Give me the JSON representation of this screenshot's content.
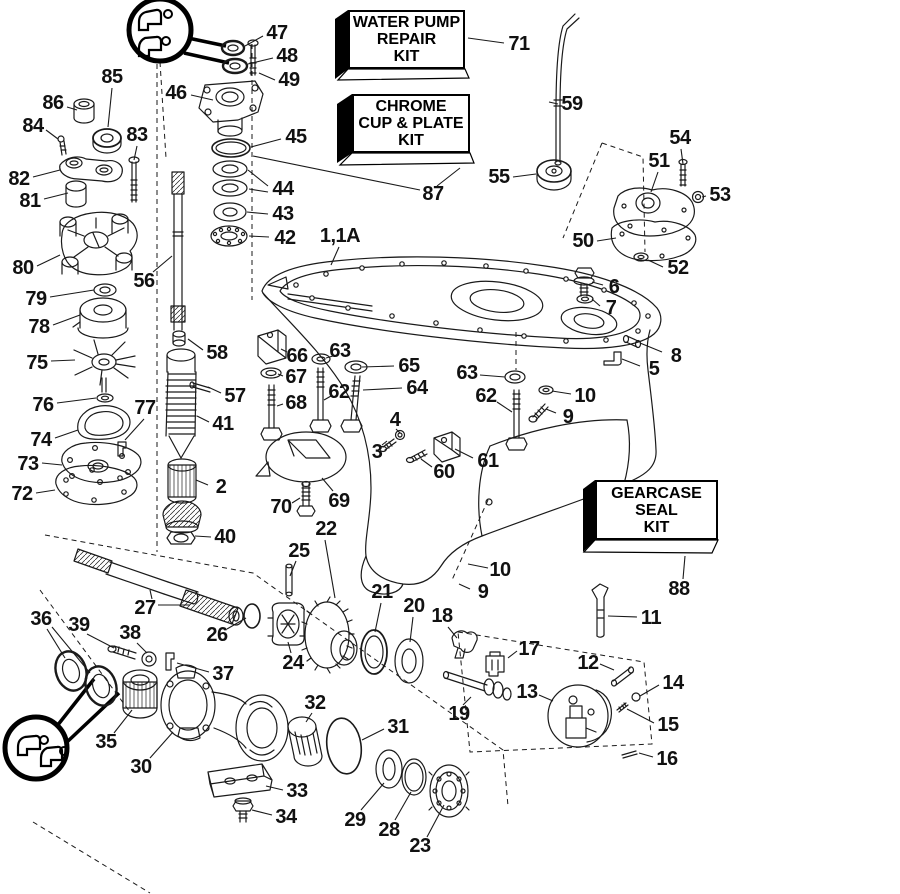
{
  "figure": {
    "background": "#ffffff",
    "ink": "#1a1a1a",
    "description": "Exploded parts diagram - outboard gearcase assembly"
  },
  "kits": {
    "water_pump": {
      "lines": [
        "WATER PUMP",
        "REPAIR",
        "KIT"
      ]
    },
    "chrome": {
      "lines": [
        "CHROME",
        "CUP & PLATE",
        "KIT"
      ]
    },
    "gearcase": {
      "lines": [
        "GEARCASE",
        "SEAL",
        "KIT"
      ]
    }
  },
  "parts": [
    {
      "n": "47",
      "x": 277,
      "y": 33,
      "l": [
        [
          263,
          36,
          245,
          46
        ]
      ]
    },
    {
      "n": "48",
      "x": 287,
      "y": 56,
      "l": [
        [
          273,
          58,
          248,
          64
        ]
      ]
    },
    {
      "n": "49",
      "x": 289,
      "y": 80,
      "l": [
        [
          275,
          80,
          259,
          73
        ]
      ]
    },
    {
      "n": "46",
      "x": 176,
      "y": 93,
      "l": [
        [
          191,
          95,
          213,
          100
        ]
      ]
    },
    {
      "n": "45",
      "x": 296,
      "y": 137,
      "l": [
        [
          281,
          139,
          251,
          147
        ]
      ]
    },
    {
      "n": "44",
      "x": 283,
      "y": 189,
      "l": [
        [
          268,
          186,
          248,
          170
        ],
        [
          268,
          192,
          249,
          189
        ]
      ]
    },
    {
      "n": "43",
      "x": 283,
      "y": 214,
      "l": [
        [
          268,
          214,
          247,
          212
        ]
      ]
    },
    {
      "n": "42",
      "x": 285,
      "y": 238,
      "l": [
        [
          269,
          237,
          249,
          236
        ]
      ]
    },
    {
      "n": "85",
      "x": 112,
      "y": 77,
      "l": [
        [
          112,
          88,
          108,
          127
        ]
      ]
    },
    {
      "n": "86",
      "x": 53,
      "y": 103,
      "l": [
        [
          67,
          107,
          77,
          110
        ]
      ]
    },
    {
      "n": "84",
      "x": 33,
      "y": 126,
      "l": [
        [
          46,
          130,
          58,
          139
        ]
      ]
    },
    {
      "n": "83",
      "x": 137,
      "y": 135,
      "l": [
        [
          137,
          146,
          134,
          160
        ]
      ]
    },
    {
      "n": "82",
      "x": 19,
      "y": 179,
      "l": [
        [
          33,
          177,
          60,
          170
        ]
      ]
    },
    {
      "n": "81",
      "x": 30,
      "y": 201,
      "l": [
        [
          44,
          199,
          68,
          193
        ]
      ]
    },
    {
      "n": "80",
      "x": 23,
      "y": 268,
      "l": [
        [
          37,
          266,
          60,
          255
        ]
      ]
    },
    {
      "n": "79",
      "x": 36,
      "y": 299,
      "l": [
        [
          50,
          297,
          94,
          290
        ]
      ]
    },
    {
      "n": "78",
      "x": 39,
      "y": 327,
      "l": [
        [
          53,
          325,
          80,
          315
        ]
      ]
    },
    {
      "n": "75",
      "x": 37,
      "y": 363,
      "l": [
        [
          51,
          361,
          75,
          360
        ]
      ]
    },
    {
      "n": "76",
      "x": 43,
      "y": 405,
      "l": [
        [
          57,
          403,
          96,
          398
        ]
      ]
    },
    {
      "n": "77",
      "x": 145,
      "y": 408,
      "l": [
        [
          144,
          419,
          125,
          440
        ]
      ]
    },
    {
      "n": "74",
      "x": 41,
      "y": 440,
      "l": [
        [
          55,
          438,
          78,
          430
        ]
      ]
    },
    {
      "n": "73",
      "x": 28,
      "y": 464,
      "l": [
        [
          42,
          463,
          62,
          465
        ]
      ]
    },
    {
      "n": "72",
      "x": 22,
      "y": 494,
      "l": [
        [
          36,
          493,
          55,
          490
        ]
      ]
    },
    {
      "n": "56",
      "x": 144,
      "y": 281,
      "l": [
        [
          153,
          272,
          172,
          256
        ]
      ]
    },
    {
      "n": "58",
      "x": 217,
      "y": 353,
      "l": [
        [
          203,
          350,
          188,
          339
        ]
      ]
    },
    {
      "n": "57",
      "x": 235,
      "y": 396,
      "l": [
        [
          221,
          393,
          208,
          387
        ]
      ]
    },
    {
      "n": "41",
      "x": 223,
      "y": 424,
      "l": [
        [
          209,
          422,
          197,
          416
        ]
      ]
    },
    {
      "n": "2",
      "x": 221,
      "y": 487,
      "l": [
        [
          208,
          485,
          196,
          480
        ]
      ]
    },
    {
      "n": "40",
      "x": 225,
      "y": 537,
      "l": [
        [
          211,
          537,
          195,
          536
        ]
      ]
    },
    {
      "n": "1,1A",
      "x": 340,
      "y": 236,
      "l": [
        [
          339,
          247,
          331,
          265
        ]
      ]
    },
    {
      "n": "87",
      "x": 433,
      "y": 194,
      "l": [
        [
          437,
          186,
          460,
          168
        ],
        [
          420,
          190,
          253,
          156
        ]
      ]
    },
    {
      "n": "71",
      "x": 519,
      "y": 44,
      "l": [
        [
          504,
          43,
          468,
          38
        ]
      ]
    },
    {
      "n": "59",
      "x": 572,
      "y": 104,
      "l": [
        [
          558,
          104,
          549,
          102
        ]
      ]
    },
    {
      "n": "55",
      "x": 499,
      "y": 177,
      "l": [
        [
          513,
          177,
          536,
          174
        ]
      ]
    },
    {
      "n": "54",
      "x": 680,
      "y": 138,
      "l": [
        [
          681,
          149,
          683,
          164
        ]
      ]
    },
    {
      "n": "51",
      "x": 659,
      "y": 161,
      "l": [
        [
          658,
          172,
          651,
          192
        ]
      ]
    },
    {
      "n": "53",
      "x": 720,
      "y": 195,
      "l": [
        [
          706,
          196,
          702,
          197
        ]
      ]
    },
    {
      "n": "50",
      "x": 583,
      "y": 241,
      "l": [
        [
          597,
          241,
          616,
          238
        ]
      ]
    },
    {
      "n": "52",
      "x": 678,
      "y": 268,
      "l": [
        [
          663,
          267,
          648,
          260
        ]
      ]
    },
    {
      "n": "6",
      "x": 614,
      "y": 287,
      "l": [
        [
          603,
          285,
          592,
          282
        ]
      ]
    },
    {
      "n": "7",
      "x": 611,
      "y": 308,
      "l": [
        [
          600,
          306,
          592,
          299
        ]
      ]
    },
    {
      "n": "8",
      "x": 676,
      "y": 356,
      "l": [
        [
          662,
          352,
          640,
          343
        ]
      ]
    },
    {
      "n": "5",
      "x": 654,
      "y": 369,
      "l": [
        [
          640,
          366,
          622,
          359
        ]
      ]
    },
    {
      "n": "66",
      "x": 297,
      "y": 356,
      "l": [
        [
          287,
          352,
          281,
          349
        ]
      ]
    },
    {
      "n": "63",
      "x": 340,
      "y": 351,
      "l": [
        [
          333,
          356,
          326,
          358
        ]
      ]
    },
    {
      "n": "67",
      "x": 296,
      "y": 377,
      "l": [
        [
          283,
          376,
          278,
          374
        ]
      ]
    },
    {
      "n": "65",
      "x": 409,
      "y": 366,
      "l": [
        [
          394,
          366,
          362,
          367
        ]
      ]
    },
    {
      "n": "62",
      "x": 339,
      "y": 392,
      "l": [
        [
          331,
          396,
          324,
          400
        ]
      ]
    },
    {
      "n": "64",
      "x": 417,
      "y": 388,
      "l": [
        [
          402,
          388,
          363,
          390
        ]
      ]
    },
    {
      "n": "68",
      "x": 296,
      "y": 403,
      "l": [
        [
          283,
          404,
          277,
          406
        ]
      ]
    },
    {
      "n": "4",
      "x": 395,
      "y": 420,
      "l": [
        [
          396,
          429,
          400,
          433
        ]
      ]
    },
    {
      "n": "3",
      "x": 377,
      "y": 452,
      "l": [
        [
          382,
          445,
          387,
          441
        ]
      ]
    },
    {
      "n": "60",
      "x": 444,
      "y": 472,
      "l": [
        [
          432,
          467,
          421,
          459
        ]
      ]
    },
    {
      "n": "61",
      "x": 488,
      "y": 461,
      "l": [
        [
          473,
          458,
          455,
          449
        ]
      ]
    },
    {
      "n": "62",
      "x": 486,
      "y": 396,
      "l": [
        [
          497,
          402,
          512,
          412
        ]
      ]
    },
    {
      "n": "63",
      "x": 467,
      "y": 373,
      "l": [
        [
          480,
          375,
          505,
          377
        ]
      ]
    },
    {
      "n": "10",
      "x": 585,
      "y": 396,
      "l": [
        [
          571,
          394,
          552,
          391
        ]
      ]
    },
    {
      "n": "9",
      "x": 568,
      "y": 417,
      "l": [
        [
          556,
          413,
          546,
          409
        ]
      ]
    },
    {
      "n": "69",
      "x": 339,
      "y": 501,
      "l": [
        [
          333,
          491,
          322,
          478
        ]
      ]
    },
    {
      "n": "70",
      "x": 281,
      "y": 507,
      "l": [
        [
          292,
          503,
          300,
          498
        ]
      ]
    },
    {
      "n": "22",
      "x": 326,
      "y": 529,
      "l": [
        [
          325,
          540,
          335,
          598
        ]
      ]
    },
    {
      "n": "25",
      "x": 299,
      "y": 551,
      "l": [
        [
          296,
          561,
          290,
          576
        ]
      ]
    },
    {
      "n": "27",
      "x": 145,
      "y": 608,
      "l": [
        [
          152,
          599,
          150,
          590
        ],
        [
          158,
          605,
          190,
          605
        ]
      ]
    },
    {
      "n": "26",
      "x": 217,
      "y": 635,
      "l": [
        [
          227,
          629,
          246,
          618
        ]
      ]
    },
    {
      "n": "36",
      "x": 41,
      "y": 619,
      "l": [
        [
          47,
          629,
          65,
          658
        ],
        [
          52,
          627,
          90,
          673
        ]
      ]
    },
    {
      "n": "39",
      "x": 79,
      "y": 625,
      "l": [
        [
          87,
          634,
          114,
          648
        ]
      ]
    },
    {
      "n": "38",
      "x": 130,
      "y": 633,
      "l": [
        [
          137,
          643,
          147,
          653
        ]
      ]
    },
    {
      "n": "24",
      "x": 293,
      "y": 663,
      "l": [
        [
          291,
          653,
          288,
          642
        ]
      ]
    },
    {
      "n": "21",
      "x": 382,
      "y": 592,
      "l": [
        [
          381,
          603,
          375,
          632
        ]
      ]
    },
    {
      "n": "20",
      "x": 414,
      "y": 606,
      "l": [
        [
          413,
          617,
          410,
          642
        ]
      ]
    },
    {
      "n": "18",
      "x": 442,
      "y": 616,
      "l": [
        [
          448,
          627,
          457,
          638
        ]
      ]
    },
    {
      "n": "37",
      "x": 223,
      "y": 674,
      "l": [
        [
          209,
          672,
          177,
          663
        ]
      ]
    },
    {
      "n": "35",
      "x": 106,
      "y": 742,
      "l": [
        [
          114,
          733,
          132,
          710
        ]
      ]
    },
    {
      "n": "30",
      "x": 141,
      "y": 767,
      "l": [
        [
          150,
          758,
          173,
          732
        ]
      ]
    },
    {
      "n": "32",
      "x": 315,
      "y": 703,
      "l": [
        [
          312,
          713,
          306,
          722
        ]
      ]
    },
    {
      "n": "31",
      "x": 398,
      "y": 727,
      "l": [
        [
          384,
          729,
          362,
          740
        ]
      ]
    },
    {
      "n": "33",
      "x": 297,
      "y": 791,
      "l": [
        [
          283,
          790,
          266,
          786
        ]
      ]
    },
    {
      "n": "34",
      "x": 286,
      "y": 817,
      "l": [
        [
          272,
          815,
          252,
          810
        ]
      ]
    },
    {
      "n": "29",
      "x": 355,
      "y": 820,
      "l": [
        [
          361,
          810,
          384,
          783
        ]
      ]
    },
    {
      "n": "28",
      "x": 389,
      "y": 830,
      "l": [
        [
          395,
          820,
          411,
          792
        ]
      ]
    },
    {
      "n": "23",
      "x": 420,
      "y": 846,
      "l": [
        [
          427,
          837,
          444,
          805
        ]
      ]
    },
    {
      "n": "19",
      "x": 459,
      "y": 714,
      "l": [
        [
          463,
          705,
          471,
          697
        ]
      ]
    },
    {
      "n": "17",
      "x": 529,
      "y": 649,
      "l": [
        [
          517,
          651,
          508,
          658
        ]
      ]
    },
    {
      "n": "12",
      "x": 588,
      "y": 663,
      "l": [
        [
          600,
          664,
          614,
          670
        ]
      ]
    },
    {
      "n": "13",
      "x": 527,
      "y": 692,
      "l": [
        [
          539,
          695,
          553,
          701
        ]
      ]
    },
    {
      "n": "14",
      "x": 673,
      "y": 683,
      "l": [
        [
          659,
          685,
          640,
          696
        ]
      ]
    },
    {
      "n": "15",
      "x": 668,
      "y": 725,
      "l": [
        [
          654,
          723,
          627,
          709
        ]
      ]
    },
    {
      "n": "16",
      "x": 667,
      "y": 759,
      "l": [
        [
          653,
          757,
          639,
          753
        ]
      ]
    },
    {
      "n": "11",
      "x": 651,
      "y": 618,
      "l": [
        [
          637,
          617,
          608,
          616
        ]
      ]
    },
    {
      "n": "88",
      "x": 679,
      "y": 589,
      "l": [
        [
          683,
          579,
          685,
          556
        ]
      ]
    },
    {
      "n": "10",
      "x": 500,
      "y": 570,
      "l": [
        [
          488,
          568,
          468,
          564
        ]
      ]
    },
    {
      "n": "9",
      "x": 483,
      "y": 592,
      "l": [
        [
          470,
          589,
          459,
          584
        ]
      ]
    }
  ]
}
